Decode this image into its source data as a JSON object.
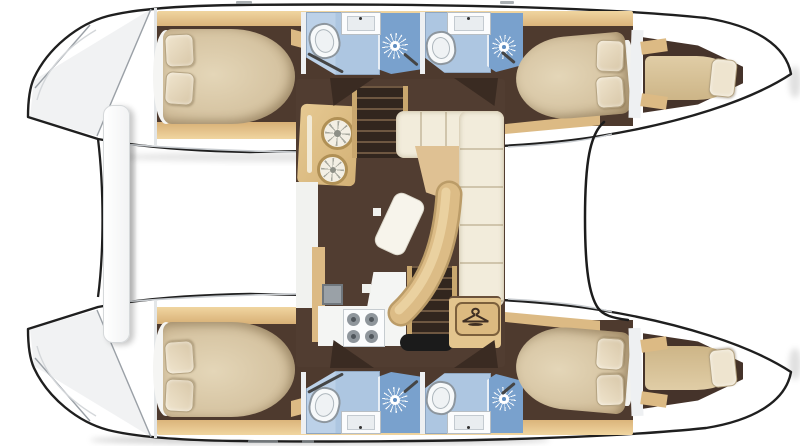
{
  "image": {
    "description": "Overhead interior floor plan of a sailing catamaran",
    "width_px": 800,
    "height_px": 446,
    "visible_text": ""
  },
  "vessel": {
    "type": "catamaran",
    "view": "top-down deck plan",
    "bows_pointing": "right",
    "hull_count": 2,
    "symmetry": "mirrored about horizontal centerline"
  },
  "labels": {
    "plan": "Catamaran floor plan",
    "hull_top": "Upper hull with aft cabin, two bathrooms and forward cabin",
    "hull_bottom": "Lower hull with aft cabin, two bathrooms and forward cabin",
    "saloon": "Central saloon with galley, stairs, sofa and curved table",
    "aft_cabin": "Aft double cabin with island bed and two pillows",
    "forward_cabin": "Forward double cabin with two pillows",
    "forepeak": "Forepeak single berth",
    "bathroom": "Bathroom with toilet, sink and separate shower",
    "shower": "Shower stall",
    "toilet": "Toilet",
    "sink": "Sink unit",
    "galley": "Galley unit with two round burners",
    "stove": "Four burner stove on white counter",
    "fridge": "Refrigerator",
    "sofa": "L-shaped cream sofa",
    "table": "Curved saloon table",
    "stairs": "Companionway stairs to hull",
    "wardrobe": "Wardrobe locker marked with coat-hanger symbol",
    "stern_platform": "Stern platforms and aft crossbar between hulls",
    "foredeck": "Foredeck boundary line between bows"
  },
  "rooms_inventory": {
    "per_hull": {
      "aft_cabin_pillows": 2,
      "bathrooms": 2,
      "toilets": 2,
      "sinks": 2,
      "shower_stalls": 2,
      "forward_cabin_pillows": 2,
      "forepeak_pillows": 1
    },
    "saloon": {
      "galley_burners": 2,
      "stove_burners": 4,
      "fridges": 1,
      "companionways": 2,
      "sofa_shape": "L",
      "table_shape": "curved arc",
      "wardrobe_icons": 1
    }
  },
  "icons": {
    "shower_head": "sun-burst rays",
    "wardrobe": "coat-hanger in rounded rectangle",
    "stove_burner": "gray circle with dark center",
    "galley_burner": "ringed circle with radial spokes"
  },
  "palette": {
    "background": "#ffffff",
    "outline": "#1f1f1f",
    "floor-dark": "#4e3a2e",
    "floor-saloon": "#513d31",
    "wood-light": "#f0d5a0",
    "wood-dark": "#d8b076",
    "wood-mid": "#dcba84",
    "bed-hi": "#e4d6b8",
    "bed-mid": "#d6c4a2",
    "bed-lo": "#bfa67f",
    "pillow-hi": "#f0e5ce",
    "pillow-lo": "#d8c7a8",
    "sofa-cream": "#f2ecdb",
    "sofa-seam": "#d0c5ac",
    "table-tan": "#dcbc86",
    "bath-light": "#bcd1e8",
    "bath-mid": "#adc6e1",
    "bath-shower": "#79a1cd",
    "fixture-white": "#f7f9fa",
    "appliance-gray": "#8f969c",
    "wedge": "#3a2b22"
  }
}
